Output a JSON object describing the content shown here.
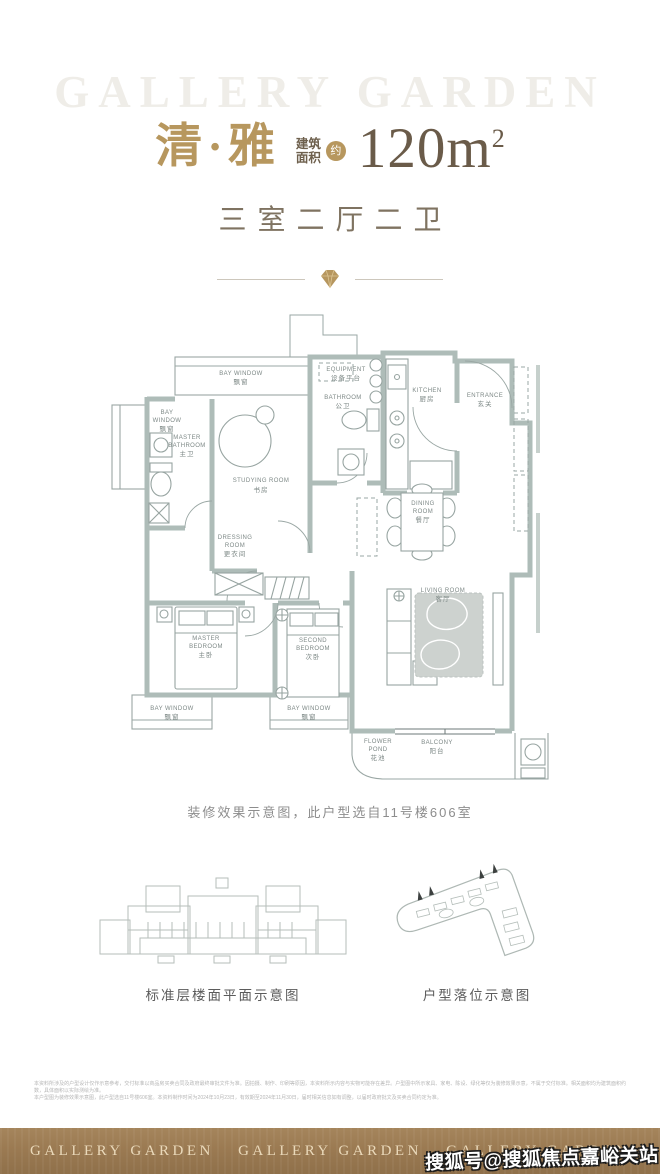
{
  "header": {
    "brand_watermark": "GALLERY GARDEN",
    "title": "清·雅",
    "area_label": [
      "建筑",
      "面积"
    ],
    "area_approx_badge": "约",
    "area_value": "120m",
    "area_exponent": "2",
    "layout_subtitle": "三室二厅二卫"
  },
  "floorplan": {
    "caption": "装修效果示意图，此户型选自11号楼606室",
    "rooms": [
      {
        "id": "bay-window-top",
        "lines": [
          "BAY WINDOW",
          "飘窗"
        ]
      },
      {
        "id": "equipment-platform",
        "lines": [
          "EQUIPMENT",
          "设备平台"
        ]
      },
      {
        "id": "bathroom",
        "lines": [
          "BATHROOM",
          "公卫"
        ]
      },
      {
        "id": "kitchen",
        "lines": [
          "KITCHEN",
          "厨房"
        ]
      },
      {
        "id": "entrance",
        "lines": [
          "ENTRANCE",
          "玄关"
        ]
      },
      {
        "id": "bay-window-left",
        "lines": [
          "BAY",
          "WINDOW",
          "飘窗"
        ]
      },
      {
        "id": "master-bathroom",
        "lines": [
          "MASTER",
          "BATHROOM",
          "主卫"
        ]
      },
      {
        "id": "studying-room",
        "lines": [
          "STUDYING ROOM",
          "书房"
        ]
      },
      {
        "id": "dressing-room",
        "lines": [
          "DRESSING",
          "ROOM",
          "更衣间"
        ]
      },
      {
        "id": "dining-room",
        "lines": [
          "DINING",
          "ROOM",
          "餐厅"
        ]
      },
      {
        "id": "master-bedroom",
        "lines": [
          "MASTER",
          "BEDROOM",
          "主卧"
        ]
      },
      {
        "id": "second-bedroom",
        "lines": [
          "SECOND",
          "BEDROOM",
          "次卧"
        ]
      },
      {
        "id": "living-room",
        "lines": [
          "LIVING ROOM",
          "客厅"
        ]
      },
      {
        "id": "bay-window-bottom-left",
        "lines": [
          "BAY WINDOW",
          "飘窗"
        ]
      },
      {
        "id": "bay-window-bottom-middle",
        "lines": [
          "BAY WINDOW",
          "飘窗"
        ]
      },
      {
        "id": "flower-pond",
        "lines": [
          "FLOWER",
          "POND",
          "花池"
        ]
      },
      {
        "id": "balcony",
        "lines": [
          "BALCONY",
          "阳台"
        ]
      }
    ]
  },
  "diagrams": {
    "floorplate_caption": "标准层楼面平面示意图",
    "siteplan_caption": "户型落位示意图"
  },
  "disclaimer": {
    "line1": "本资料所涉及的户型设计仅作示意参考，交付标准以商品房买卖合同及政府最终审批文件为准。因拍摄、制作、印刷等原因，本资料所示内容与实物可能存在差异。户型图中所示家具、家电、陈设、绿化等仅为装修效果示意，不属于交付标准。相关面积均为建筑面积约数，具体面积以实际测绘为准。",
    "line2": "本户型图为装修效果示意图，此户型选自11号楼606室。本资料制作时间为2024年10月23日，有效期至2024年11月30日，届时相关信息如有调整，以届时政府批文及买卖合同约定为准。"
  },
  "footer": {
    "brands": [
      "GALLERY GARDEN",
      "GALLERY GARDEN",
      "GALLERY GARDEN"
    ],
    "sohu_watermark": "搜狐号@搜狐焦点嘉峪关站"
  },
  "colors": {
    "gold": "#b7975e",
    "title_brown": "#6a5b49",
    "subtitle_brown": "#7f7361",
    "wall": "#aebcb8",
    "plan_line": "#9aa7a4",
    "rug": "#cdd2cf",
    "footer_bar": "#9b7a52",
    "footer_text": "#ead9ba"
  }
}
